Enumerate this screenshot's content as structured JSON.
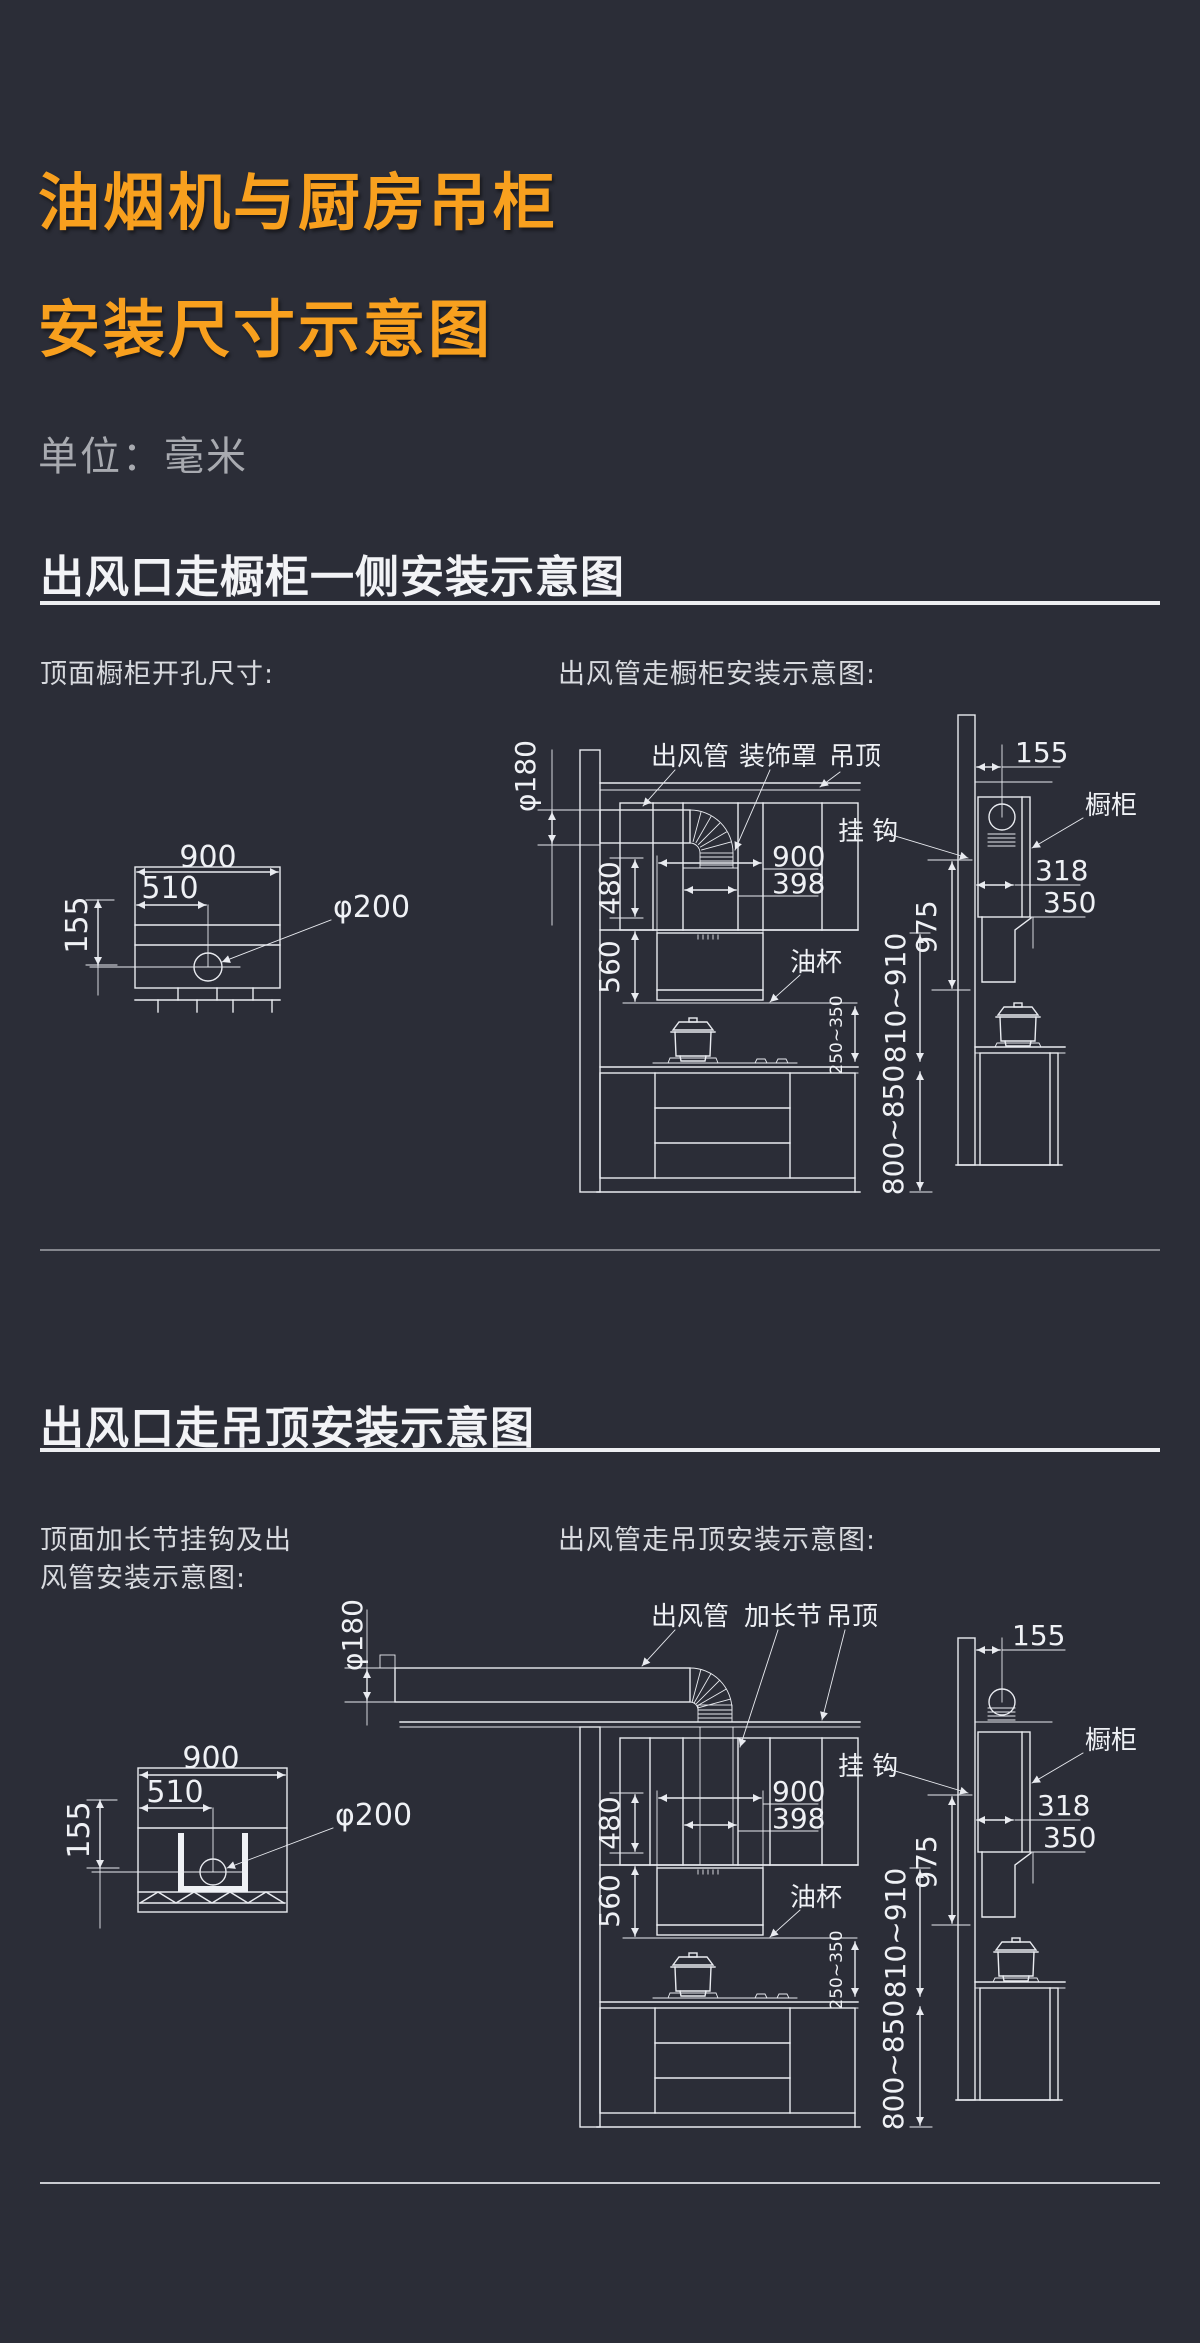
{
  "page": {
    "title_line1": "油烟机与厨房吊柜",
    "title_line2": "安装尺寸示意图",
    "unit_label": "单位：毫米"
  },
  "colors": {
    "background": "#2B2D37",
    "accent_orange": "#F8A01E",
    "line_white": "#E9EBF0",
    "muted_gray": "#A8AAB0"
  },
  "section1": {
    "heading": "出风口走橱柜一侧安装示意图",
    "left_caption": "顶面橱柜开孔尺寸:",
    "right_caption": "出风管走橱柜安装示意图:"
  },
  "section2": {
    "heading": "出风口走吊顶安装示意图",
    "left_caption_line1": "顶面加长节挂钩及出",
    "left_caption_line2": "风管安装示意图:",
    "right_caption": "出风管走吊顶安装示意图:"
  },
  "cutout": {
    "width": "900",
    "offset": "510",
    "edge": "155",
    "hole": "φ200"
  },
  "labels": {
    "duct": "出风管",
    "cover": "装饰罩",
    "extension": "加长节",
    "ceiling": "吊顶",
    "hook": "挂 钩",
    "cabinet": "橱柜",
    "oil_cup": "油杯"
  },
  "dims": {
    "duct_dia": "φ180",
    "hood_width": "900",
    "cover_width": "398",
    "hood_top": "480",
    "hood_height": "560",
    "hob_gap": "250~350",
    "mount_range": "810~910",
    "counter_height": "800~850",
    "wall_gap": "155",
    "depth": "318",
    "bottom_depth": "350",
    "hook_height": "975"
  }
}
